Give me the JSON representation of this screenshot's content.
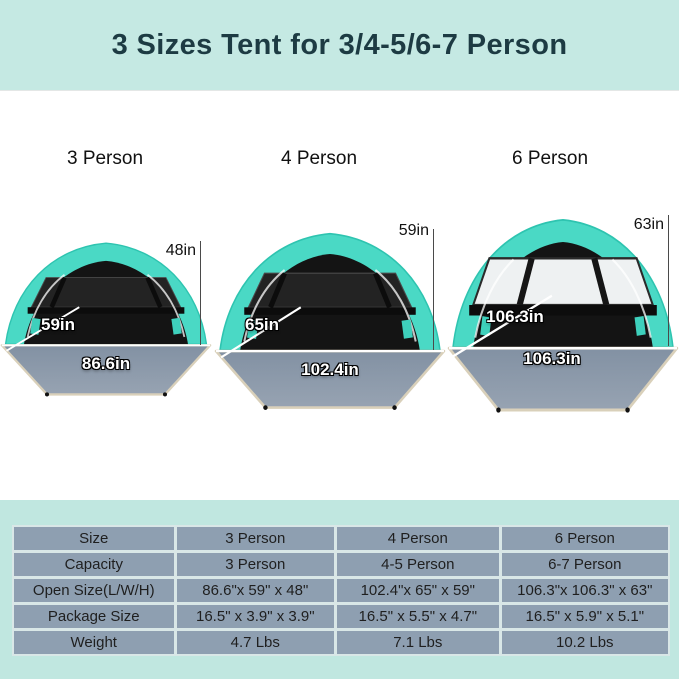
{
  "header": {
    "title": "3 Sizes Tent for 3/4-5/6-7 Person"
  },
  "tents": [
    {
      "label": "3 Person",
      "height": "48in",
      "depth": "59in",
      "width": "86.6in"
    },
    {
      "label": "4 Person",
      "height": "59in",
      "depth": "65in",
      "width": "102.4in"
    },
    {
      "label": "6 Person",
      "height": "63in",
      "depth": "106.3in",
      "width": "106.3in"
    }
  ],
  "spec_table": {
    "rows": [
      {
        "label": "Size",
        "values": [
          "3 Person",
          "4 Person",
          "6 Person"
        ]
      },
      {
        "label": "Capacity",
        "values": [
          "3 Person",
          "4-5 Person",
          "6-7 Person"
        ]
      },
      {
        "label": "Open Size(L/W/H)",
        "values": [
          "86.6\"x 59\" x 48\"",
          "102.4\"x 65\" x 59\"",
          "106.3\"x 106.3\" x 63\""
        ]
      },
      {
        "label": "Package Size",
        "values": [
          "16.5\" x 3.9\" x 3.9\"",
          "16.5\" x 5.5\" x 4.7\"",
          "16.5\" x 5.9\" x 5.1\""
        ]
      },
      {
        "label": "Weight",
        "values": [
          "4.7 Lbs",
          "7.1 Lbs",
          "10.2 Lbs"
        ]
      }
    ]
  },
  "colors": {
    "banner_bg": "#c5e9e3",
    "banner_text": "#1d3b43",
    "tent_teal": "#4ad9c5",
    "floor_gray": "#8c9aab",
    "floor_edge_tan": "#d9d0ba",
    "table_cell_bg": "#8e9fb1",
    "footer_bg": "#c0e7e0"
  }
}
